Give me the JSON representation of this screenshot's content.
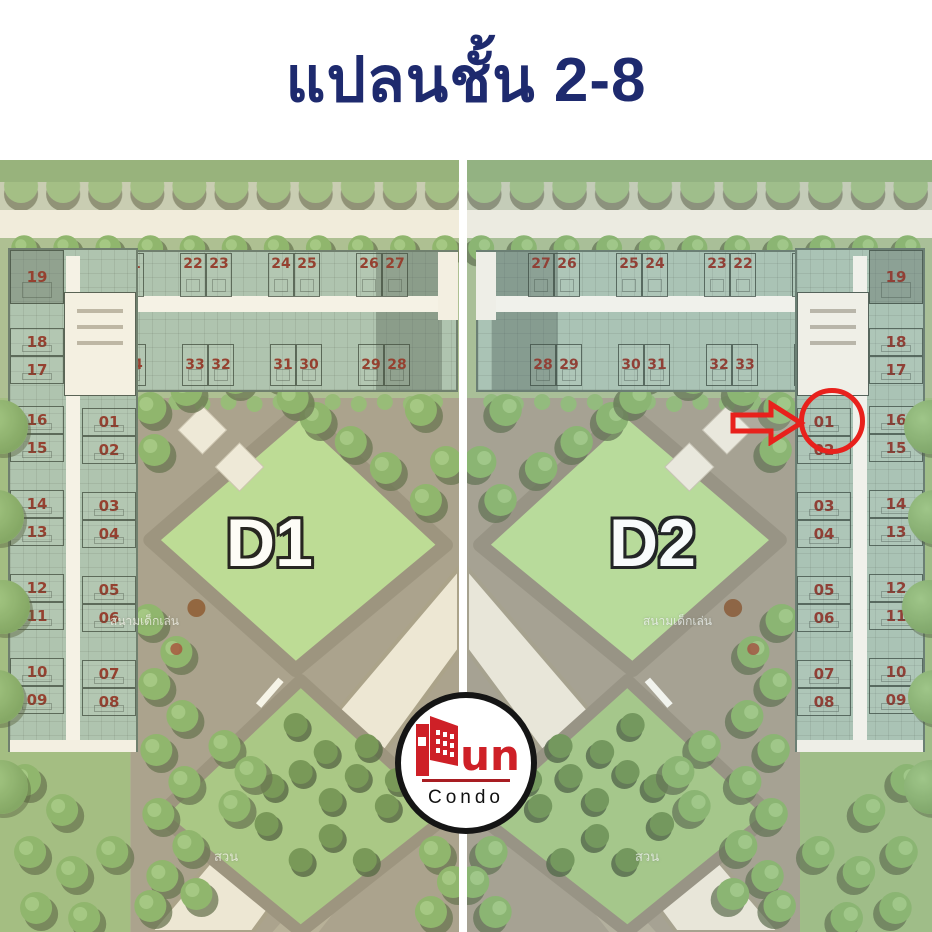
{
  "title": "แปลนชั้น 2-8",
  "annotation": {
    "type": "red-arrow-and-circle",
    "building": "D2",
    "unit": "01"
  },
  "plans": {
    "d1": {
      "label": "D1",
      "top_row": [
        "20",
        "21",
        "22",
        "23",
        "24",
        "25",
        "26",
        "27"
      ],
      "bottom_row": [
        "34",
        "33",
        "32",
        "31",
        "30",
        "29",
        "28"
      ],
      "outer_col": [
        "19",
        "18",
        "17",
        "16",
        "15",
        "14",
        "13",
        "12",
        "11",
        "10",
        "09"
      ],
      "inner_col": [
        "01",
        "02",
        "03",
        "04",
        "05",
        "06",
        "07",
        "08"
      ],
      "playground_label": "สนามเด็กเล่น",
      "garden_label": "สวน"
    },
    "d2": {
      "label": "D2",
      "top_row": [
        "27",
        "26",
        "25",
        "24",
        "23",
        "22",
        "21",
        "20"
      ],
      "bottom_row": [
        "28",
        "29",
        "30",
        "31",
        "32",
        "33",
        "34"
      ],
      "outer_col": [
        "19",
        "18",
        "17",
        "16",
        "15",
        "14",
        "13",
        "12",
        "11",
        "10",
        "09"
      ],
      "inner_col": [
        "01",
        "02",
        "03",
        "04",
        "05",
        "06",
        "07",
        "08"
      ],
      "playground_label": "สนามเด็กเล่น",
      "garden_label": "สวน"
    }
  },
  "logo": {
    "brand": "Pun",
    "brand_suffix": "un",
    "sub": "Condo"
  }
}
